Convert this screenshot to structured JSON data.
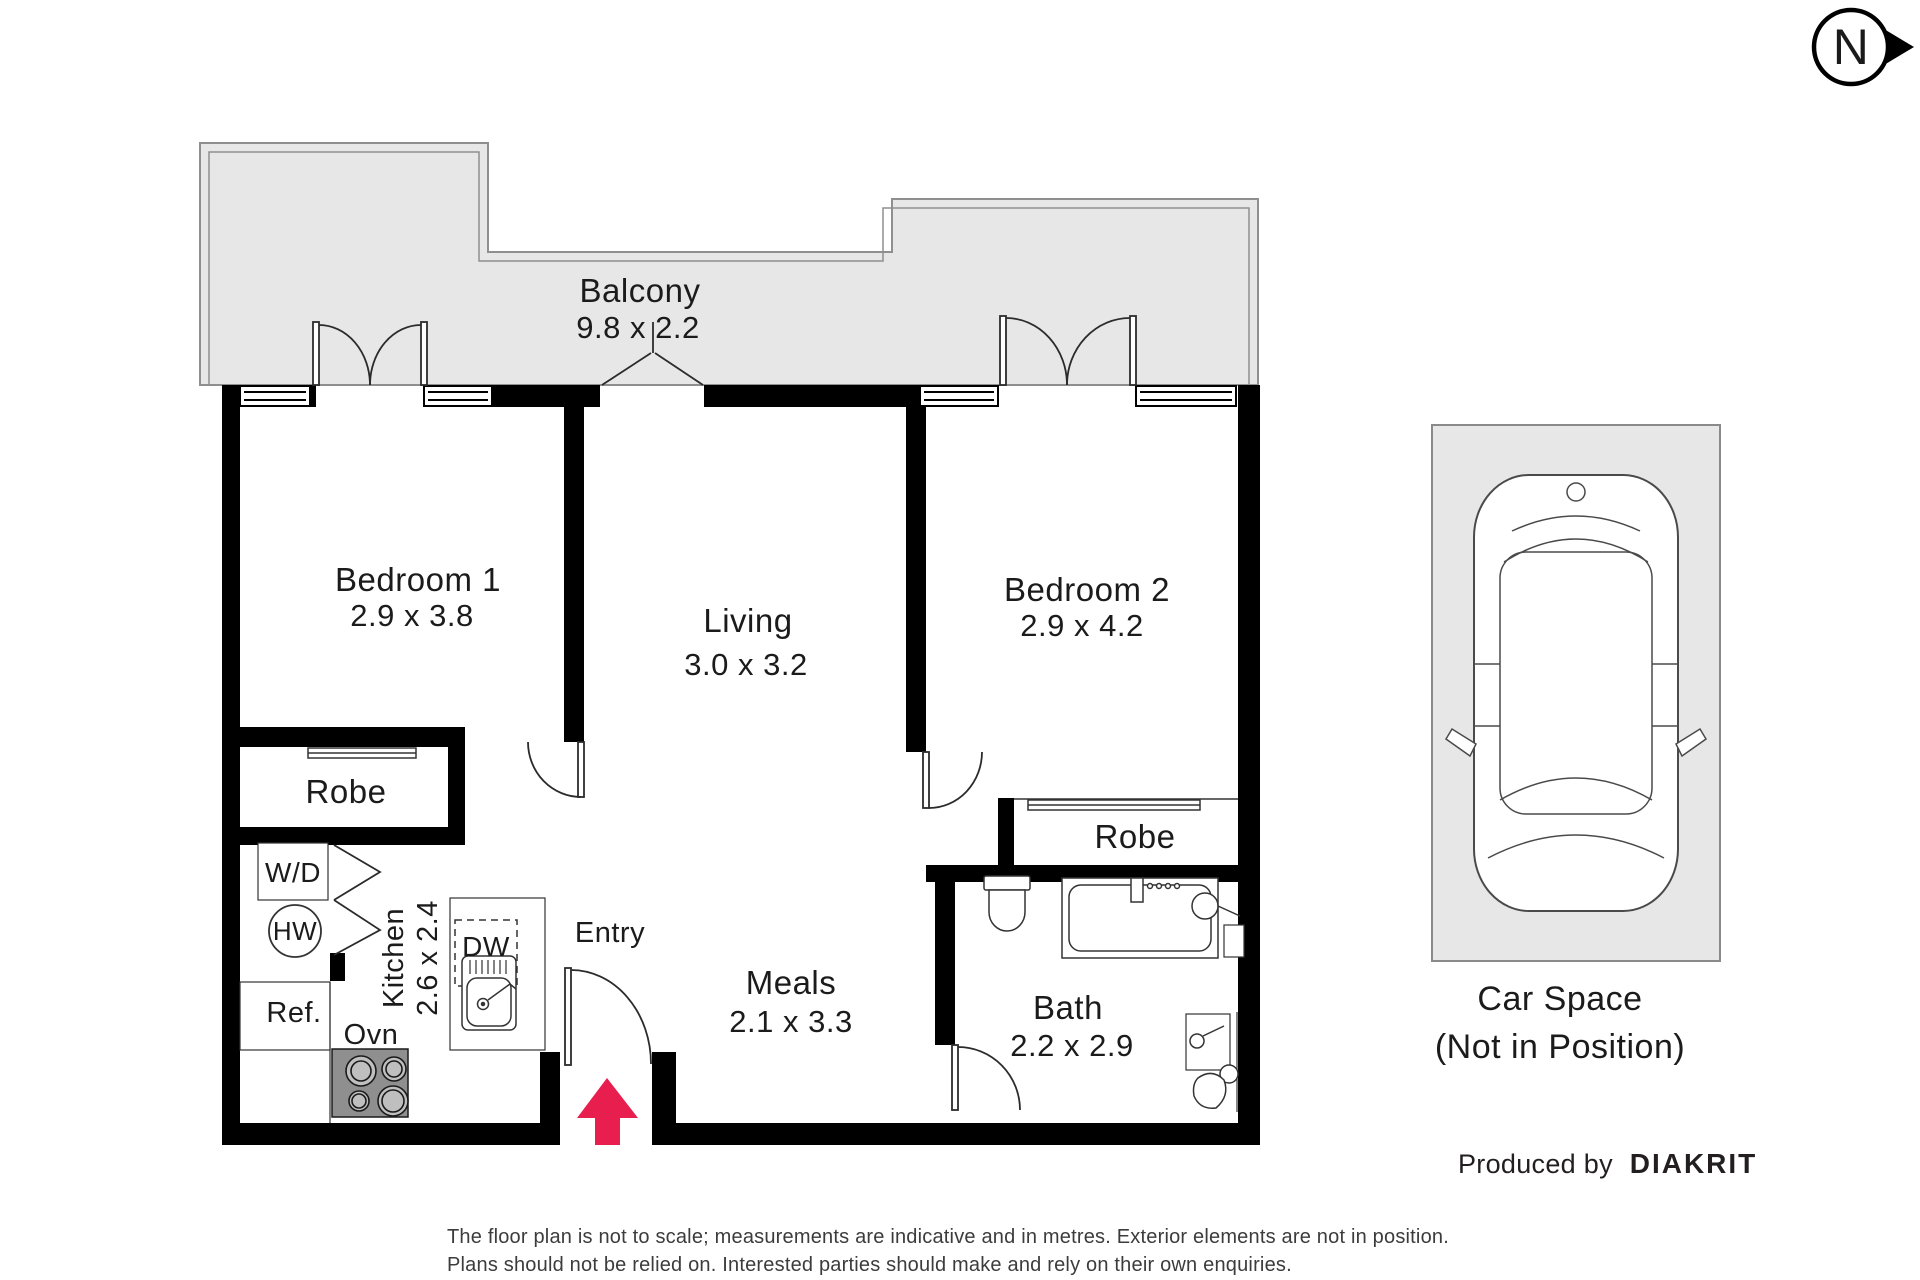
{
  "north": {
    "label": "N"
  },
  "rooms": {
    "balcony": {
      "name": "Balcony",
      "dims": "9.8 x 2.2"
    },
    "bedroom1": {
      "name": "Bedroom 1",
      "dims": "2.9 x 3.8"
    },
    "living": {
      "name": "Living",
      "dims": "3.0 x 3.2"
    },
    "bedroom2": {
      "name": "Bedroom 2",
      "dims": "2.9 x 4.2"
    },
    "robe1": {
      "name": "Robe"
    },
    "robe2": {
      "name": "Robe"
    },
    "kitchen": {
      "name": "Kitchen",
      "dims": "2.6 x 2.4"
    },
    "meals": {
      "name": "Meals",
      "dims": "2.1 x 3.3"
    },
    "bath": {
      "name": "Bath",
      "dims": "2.2 x 2.9"
    },
    "entry": {
      "name": "Entry"
    }
  },
  "fixtures": {
    "washer_dryer": "W/D",
    "hot_water": "HW",
    "refrigerator": "Ref.",
    "oven": "Ovn",
    "dishwasher": "DW"
  },
  "car_space": {
    "title": "Car Space",
    "subtitle": "(Not in Position)"
  },
  "credit": {
    "prefix": "Produced by",
    "brand": "DIAKRIT"
  },
  "disclaimer": {
    "line1": "The floor plan is not to scale; measurements are indicative and in metres. Exterior elements are not in position.",
    "line2": "Plans should not be relied on. Interested parties should make and rely on their own enquiries."
  },
  "colors": {
    "arrow": "#e81e4e",
    "balcony_fill": "#e7e7e7",
    "wall": "#000000",
    "stove": "#8f8f8f"
  }
}
